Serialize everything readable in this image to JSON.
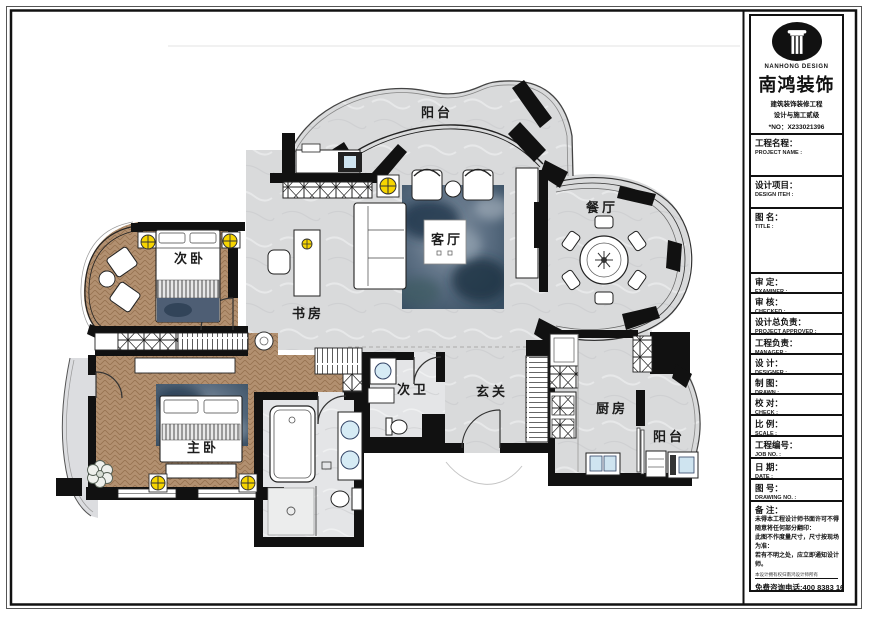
{
  "plan": {
    "rooms": [
      {
        "id": "balcony-top",
        "label": "阳台"
      },
      {
        "id": "bedroom-second",
        "label": "次卧"
      },
      {
        "id": "study",
        "label": "书房"
      },
      {
        "id": "living-room",
        "label": "客厅"
      },
      {
        "id": "dining-room",
        "label": "餐厅"
      },
      {
        "id": "bathroom-second",
        "label": "次卫"
      },
      {
        "id": "foyer",
        "label": "玄关"
      },
      {
        "id": "bedroom-master",
        "label": "主卧"
      },
      {
        "id": "kitchen",
        "label": "厨房"
      },
      {
        "id": "balcony-service",
        "label": "阳台"
      }
    ]
  },
  "logo": {
    "brand_en": "NANHONG DESIGN",
    "brand_cn": "南鸿装饰",
    "cert_line1": "建筑装饰装修工程",
    "cert_line2": "设计与施工贰级",
    "license_no": "*NO：X233021396"
  },
  "title_block": {
    "fields": [
      {
        "cn": "工程名程：",
        "en": "PROJECT NAME :"
      },
      {
        "cn": "设计项目：",
        "en": "DESIGN ITEH :"
      },
      {
        "cn": "图 名：",
        "en": "TITLE :"
      },
      {
        "cn": "审 定：",
        "en": "EXAMINER :"
      },
      {
        "cn": "审 核：",
        "en": "CHECKED :"
      },
      {
        "cn": "设计总负责：",
        "en": "PROJECT APPROVED :"
      },
      {
        "cn": "工程负责：",
        "en": "MANAGER :"
      },
      {
        "cn": "设 计：",
        "en": "DESIGNER :"
      },
      {
        "cn": "制 图：",
        "en": "DRAWN :"
      },
      {
        "cn": "校 对：",
        "en": "CHECK :"
      },
      {
        "cn": "比 例：",
        "en": "SCALE :"
      },
      {
        "cn": "工程编号：",
        "en": "JOB NO. :"
      },
      {
        "cn": "日 期：",
        "en": "DATE :"
      },
      {
        "cn": "图 号：",
        "en": "DRAWING NO. :"
      }
    ],
    "notes": {
      "title": "备 注：",
      "lines": [
        "未得本工程设计师书面许可不得",
        "随意将任何部分翻印：",
        "此图不作度量尺寸，尺寸按现场",
        "为准：",
        "若有不明之处，应立即通知设计",
        "师。"
      ],
      "fine_print": "本设计拥有权归南鸿设计师所有",
      "hotline": "免费咨询电话:400 8383 168"
    }
  },
  "colors": {
    "wall": "#111111",
    "floor_gray": "#d9dadb",
    "wood": "#b29070",
    "rug_blue": "#46586c",
    "light_yellow": "#f7d500",
    "fixture_blue": "#d6ebf5"
  }
}
